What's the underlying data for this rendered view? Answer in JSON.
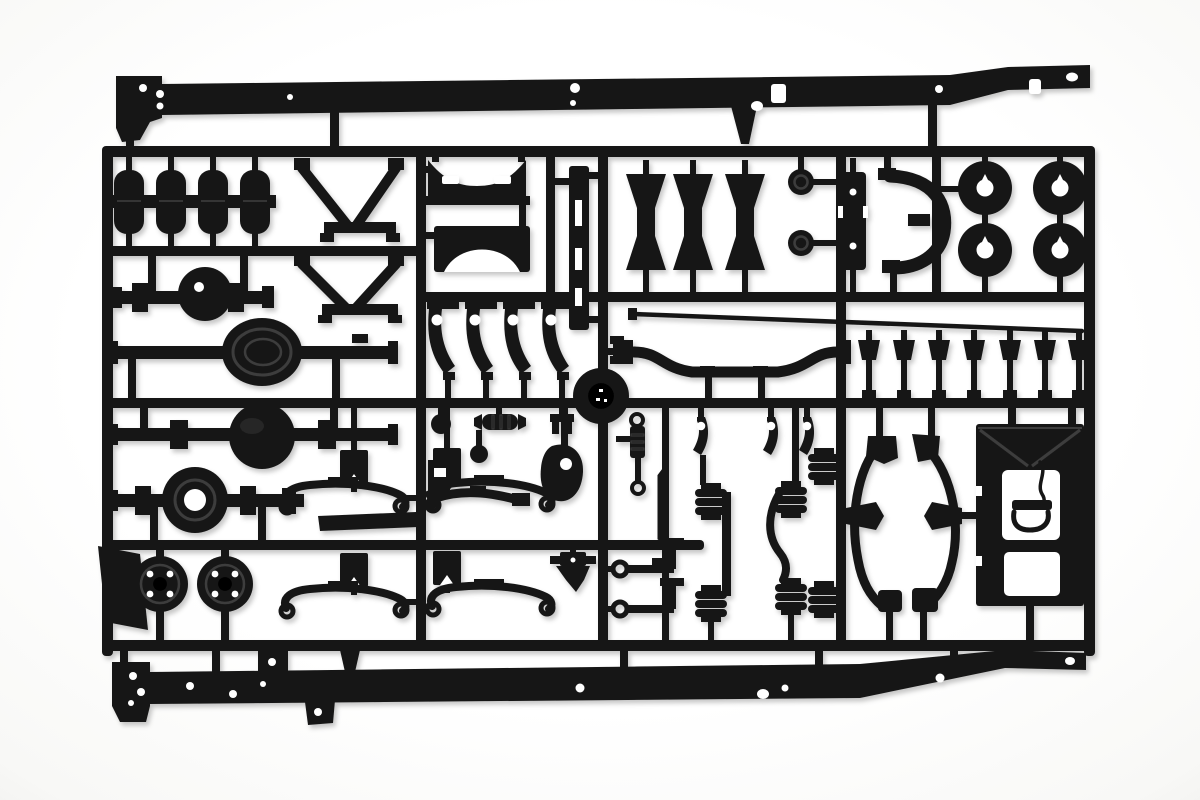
{
  "image": {
    "kind": "product photograph",
    "subject": "Black injection-molded plastic model kit sprue (parts tree) with truck chassis components on a white background",
    "visible_text": ""
  },
  "colors": {
    "background": "#ffffff",
    "vignette": "#efefed",
    "plastic": "#191919",
    "plastic_dark": "#060606",
    "plastic_highlight": "#343434",
    "detail_rib": "#3d3d3d"
  },
  "parts": [
    {
      "name": "chassis-side-rail",
      "count": 2
    },
    {
      "name": "runner-frame",
      "count": 1
    },
    {
      "name": "air-tank",
      "count": 4
    },
    {
      "name": "v-brace",
      "count": 2
    },
    {
      "name": "arched-crossmember",
      "count": 2
    },
    {
      "name": "channel-strip",
      "count": 1
    },
    {
      "name": "bobbin-spacer",
      "count": 3
    },
    {
      "name": "hub-cap",
      "count": 2
    },
    {
      "name": "mounting-plate",
      "count": 1
    },
    {
      "name": "curved-bracket",
      "count": 1
    },
    {
      "name": "wheel-disc",
      "count": 4
    },
    {
      "name": "axle-housing",
      "count": 4
    },
    {
      "name": "brake-drum",
      "count": 2
    },
    {
      "name": "mudflap-plate",
      "count": 1
    },
    {
      "name": "leaf-spring",
      "count": 4
    },
    {
      "name": "spring-bracket",
      "count": 4
    },
    {
      "name": "spring-shackle",
      "count": 4
    },
    {
      "name": "center-disc",
      "count": 1
    },
    {
      "name": "tie-rod",
      "count": 1
    },
    {
      "name": "stabilizer-bar",
      "count": 1
    },
    {
      "name": "frame-clamp",
      "count": 7
    },
    {
      "name": "round-knob",
      "count": 2
    },
    {
      "name": "ribbed-sleeve",
      "count": 1
    },
    {
      "name": "fork-bracket",
      "count": 1
    },
    {
      "name": "corner-bracket",
      "count": 1
    },
    {
      "name": "steering-gearbox",
      "count": 1
    },
    {
      "name": "pitman-arm",
      "count": 1
    },
    {
      "name": "shock-absorber",
      "count": 1
    },
    {
      "name": "lever-arm",
      "count": 3
    },
    {
      "name": "air-bellows",
      "count": 6
    },
    {
      "name": "linkage-rod",
      "count": 1
    },
    {
      "name": "torque-rod",
      "count": 2
    },
    {
      "name": "coupler-block",
      "count": 1
    },
    {
      "name": "fender-arch",
      "count": 2
    },
    {
      "name": "rear-panel",
      "count": 1
    },
    {
      "name": "battery-tray-strip",
      "count": 1
    }
  ]
}
